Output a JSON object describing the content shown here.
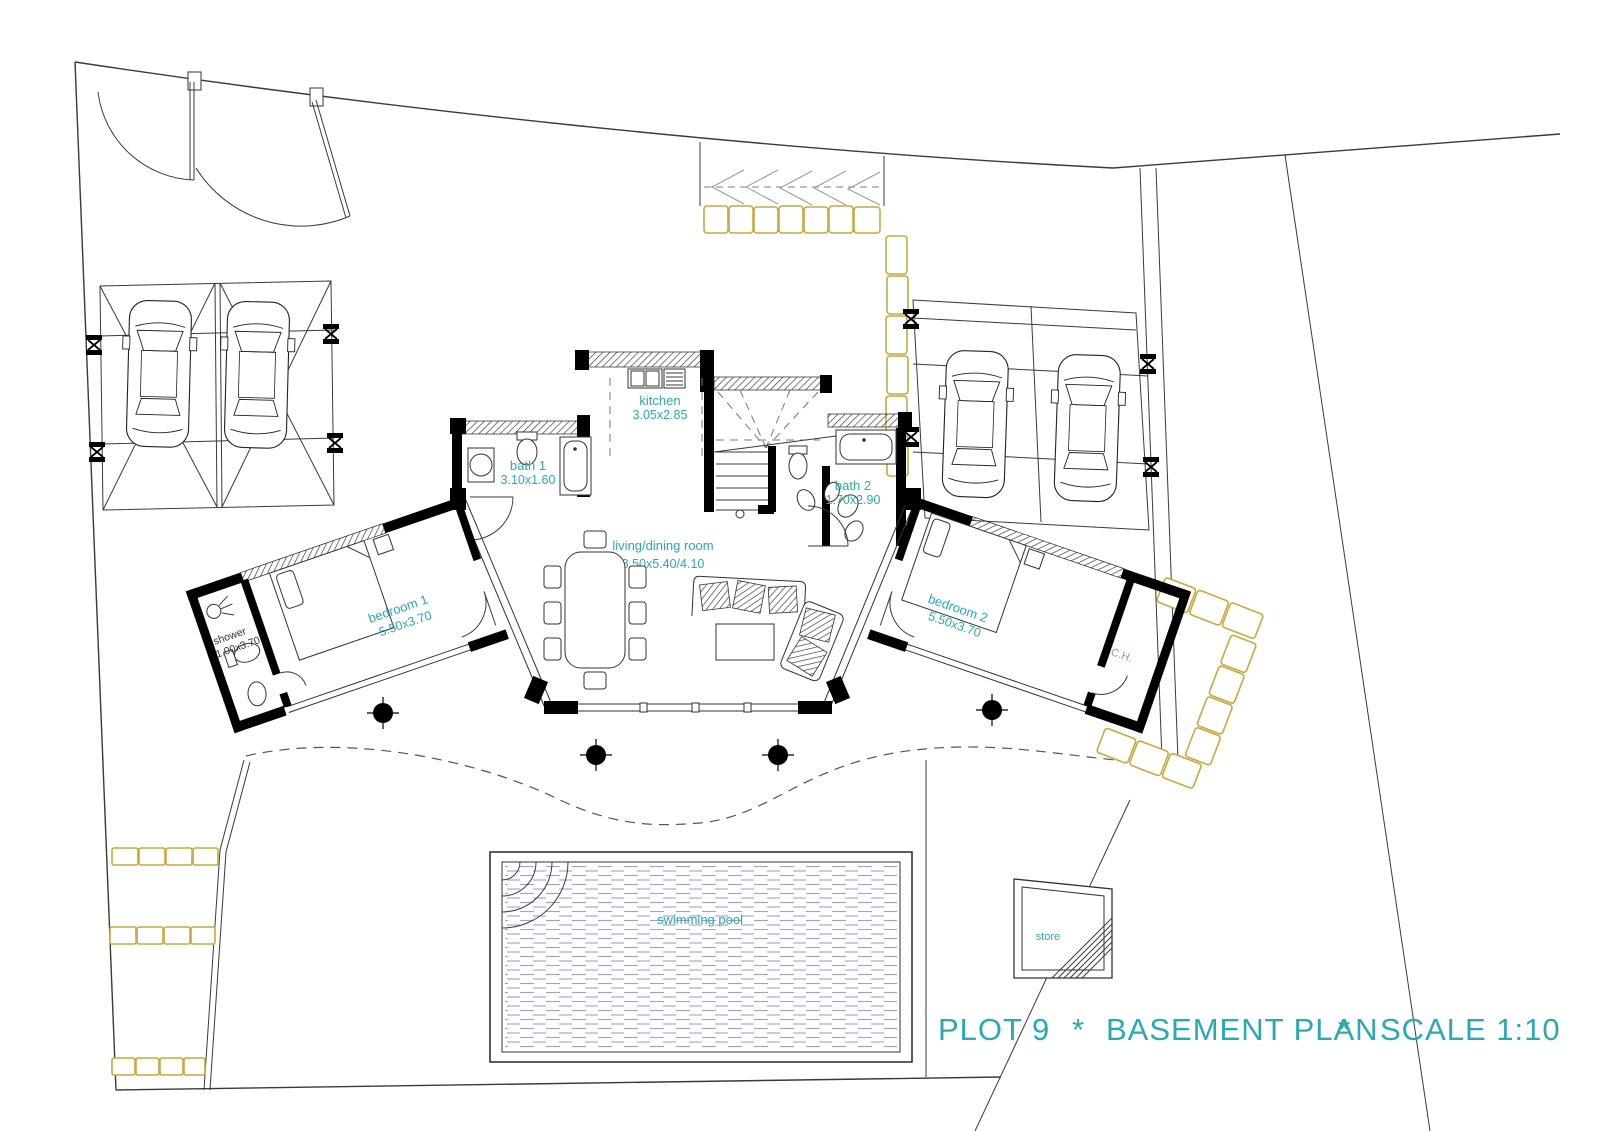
{
  "title": {
    "plot": "PLOT 9",
    "sep1": "*",
    "name": "BASEMENT PLAN",
    "sep2": "*",
    "scale": "SCALE 1:10"
  },
  "rooms": {
    "kitchen": {
      "name": "kitchen",
      "dims": "3.05x2.85"
    },
    "bath1": {
      "name": "bath 1",
      "dims": "3.10x1.60"
    },
    "bath2": {
      "name": "bath 2",
      "dims": "1.70x2.90"
    },
    "living": {
      "name": "living/dining room",
      "dims": "8.50x5.40/4.10"
    },
    "bedroom1": {
      "name": "bedroom 1",
      "dims": "5.50x3.70"
    },
    "bedroom2": {
      "name": "bedroom 2",
      "dims": "5.50x3.70"
    },
    "shower": {
      "name": "shower",
      "dims": "1.00x3.70"
    },
    "ch": {
      "name": "C.H."
    },
    "pool": {
      "name": "swimming pool"
    },
    "store": {
      "name": "store"
    }
  },
  "colors": {
    "teal": "#2AA9B4",
    "teal-soft": "#6FA9BD",
    "stone": "#C9A93F",
    "water": "#96A2D8",
    "line": "#3a3a3a",
    "wall": "#000000"
  }
}
